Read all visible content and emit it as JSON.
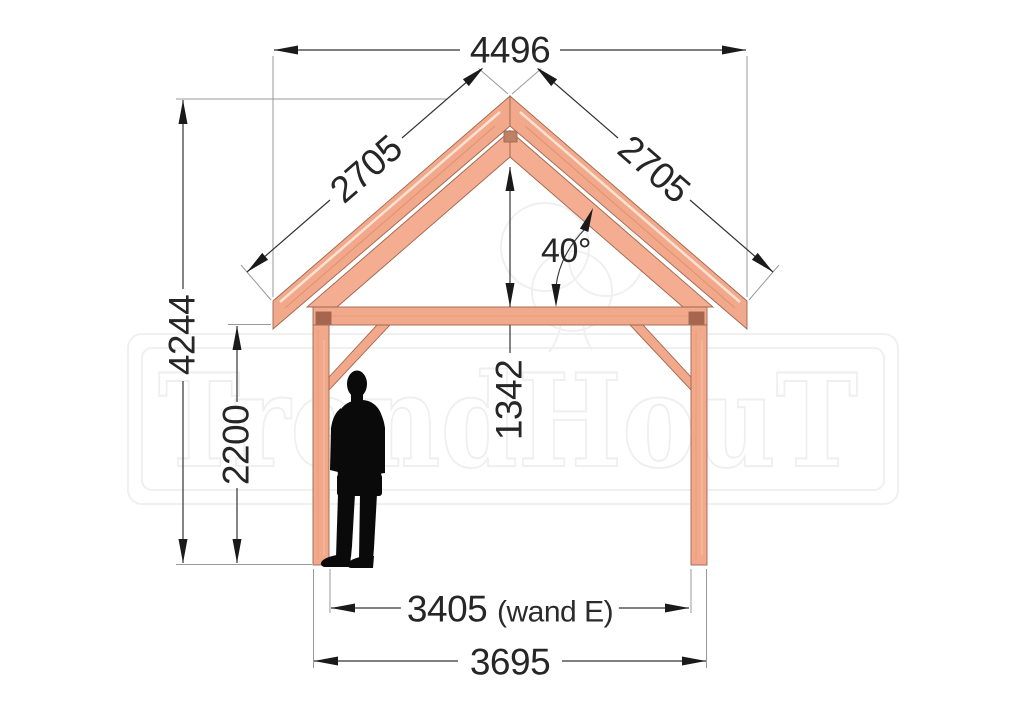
{
  "drawing": {
    "title": "timber-frame-front-elevation",
    "dimensions": {
      "roof_width": "4496",
      "rafter_left": "2705",
      "rafter_right": "2705",
      "roof_angle": "40°",
      "total_height": "4244",
      "post_height": "2200",
      "truss_height": "1342",
      "inner_span": "3405",
      "inner_span_note": "(wand E)",
      "outer_span": "3695"
    },
    "watermark": {
      "text": "TrendHouT"
    },
    "colors": {
      "timber": "#f2a88a",
      "timber_outline": "#9d6850",
      "timber_joint": "#a8654e",
      "dimension_line": "#333333",
      "extension_line": "#999999",
      "text": "#262626",
      "watermark": "#efefef",
      "silhouette": "#0a0a0a"
    }
  }
}
